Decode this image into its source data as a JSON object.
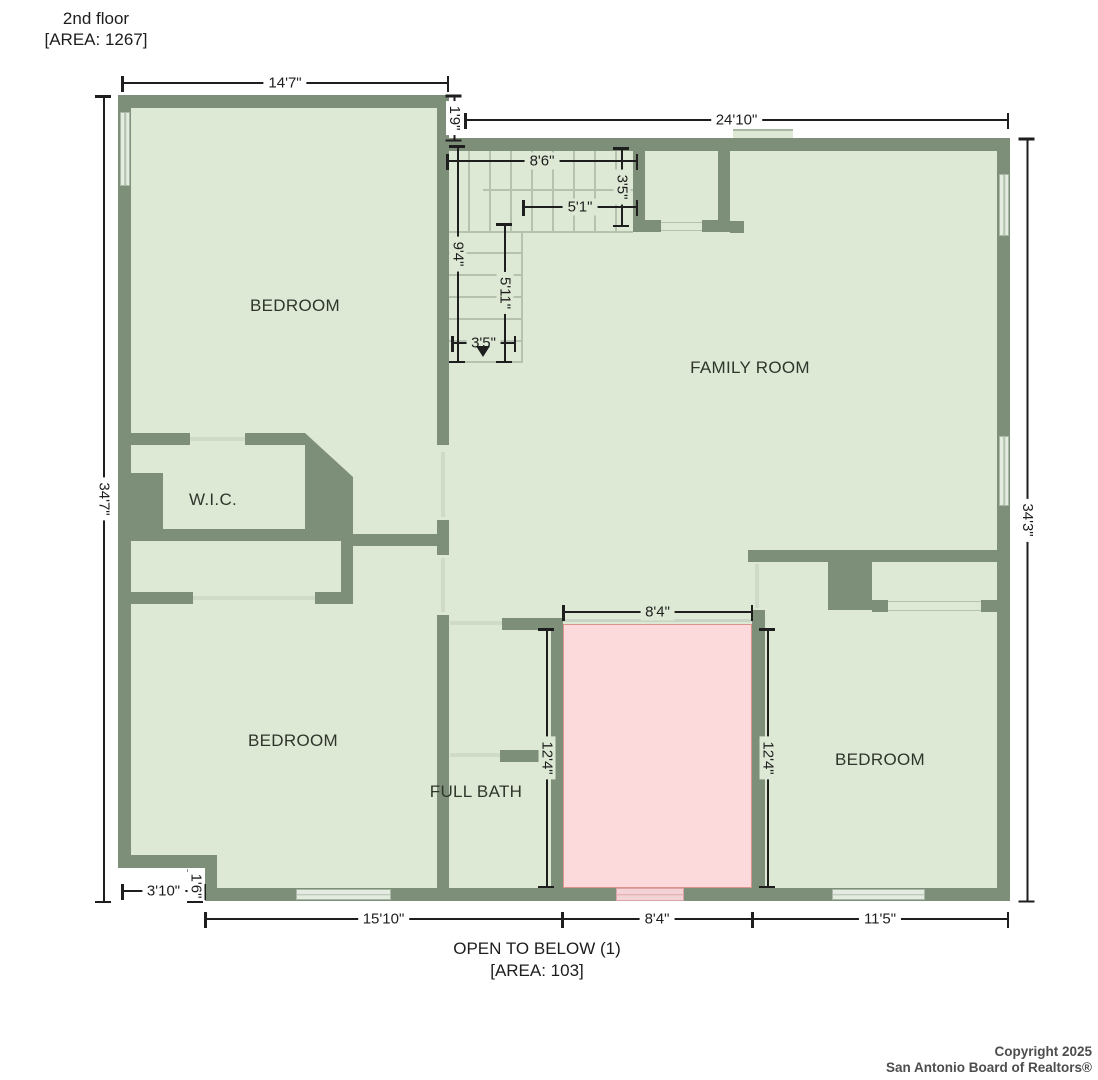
{
  "title": {
    "line1": "2nd floor",
    "line2": "[AREA: 1267]"
  },
  "footer": {
    "line1": "OPEN TO BELOW (1)",
    "line2": "[AREA: 103]"
  },
  "copyright": {
    "line1": "Copyright 2025",
    "line2": "San Antonio Board of Realtors®"
  },
  "rooms": {
    "bedroom1": "BEDROOM",
    "family": "FAMILY ROOM",
    "wic": "W.I.C.",
    "bedroom2": "BEDROOM",
    "bath": "FULL BATH",
    "bedroom3": "BEDROOM"
  },
  "dims": {
    "top_left": "14'7\"",
    "offset": "1'9\"",
    "top_right": "24'10\"",
    "left": "34'7\"",
    "right": "34'3\"",
    "stair_top": "8'6\"",
    "stair_right": "3'5\"",
    "stair_mid": "5'1\"",
    "stair_left": "9'4\"",
    "stair_lower": "5'11\"",
    "stair_bottom": "3'5\"",
    "open_top": "8'4\"",
    "open_left": "12'4\"",
    "open_right": "12'4\"",
    "notch_width": "3'10\"",
    "notch_height": "1'6\"",
    "bottom_left": "15'10\"",
    "bottom_mid": "8'4\"",
    "bottom_right": "11'5\""
  },
  "colors": {
    "wall": "#7e8f79",
    "floor": "#dde9d5",
    "tread": "#b6c2b0",
    "door": "#cfdac8",
    "window_frame": "#a9b8a5",
    "window_glass": "#e4ebe1",
    "open_fill": "#fcd9da",
    "open_border": "#dd928e",
    "open_wall": "#b18a88",
    "open_window": "#f3d3d6",
    "open_window_frame": "#d9a3a8",
    "dim": "#1e1e1e",
    "label": "#2f352b",
    "paper": "#ffffff",
    "copyright": "#4d4d4d"
  }
}
